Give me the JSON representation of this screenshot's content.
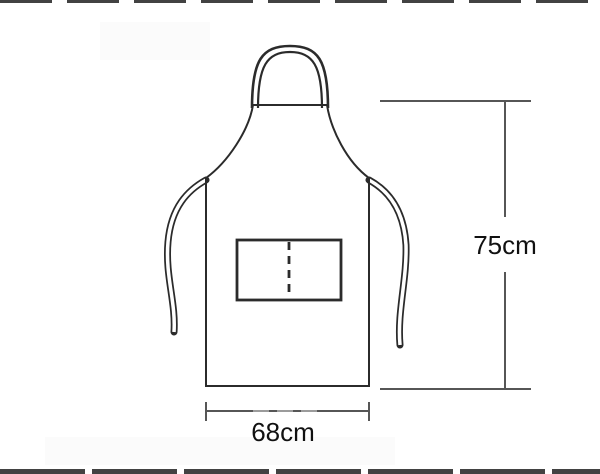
{
  "diagram": {
    "subject": "Apron line drawing with dimension annotations",
    "labels": {
      "height": "75cm",
      "width": "68cm"
    },
    "colors": {
      "background": "#ffffff",
      "outline": "#2b2b2b",
      "dimension": "#565656",
      "dimension_faded": "#9b9b9b",
      "text": "#111111",
      "artifact": "#424242",
      "faint_block": "#fbfbfb"
    }
  }
}
